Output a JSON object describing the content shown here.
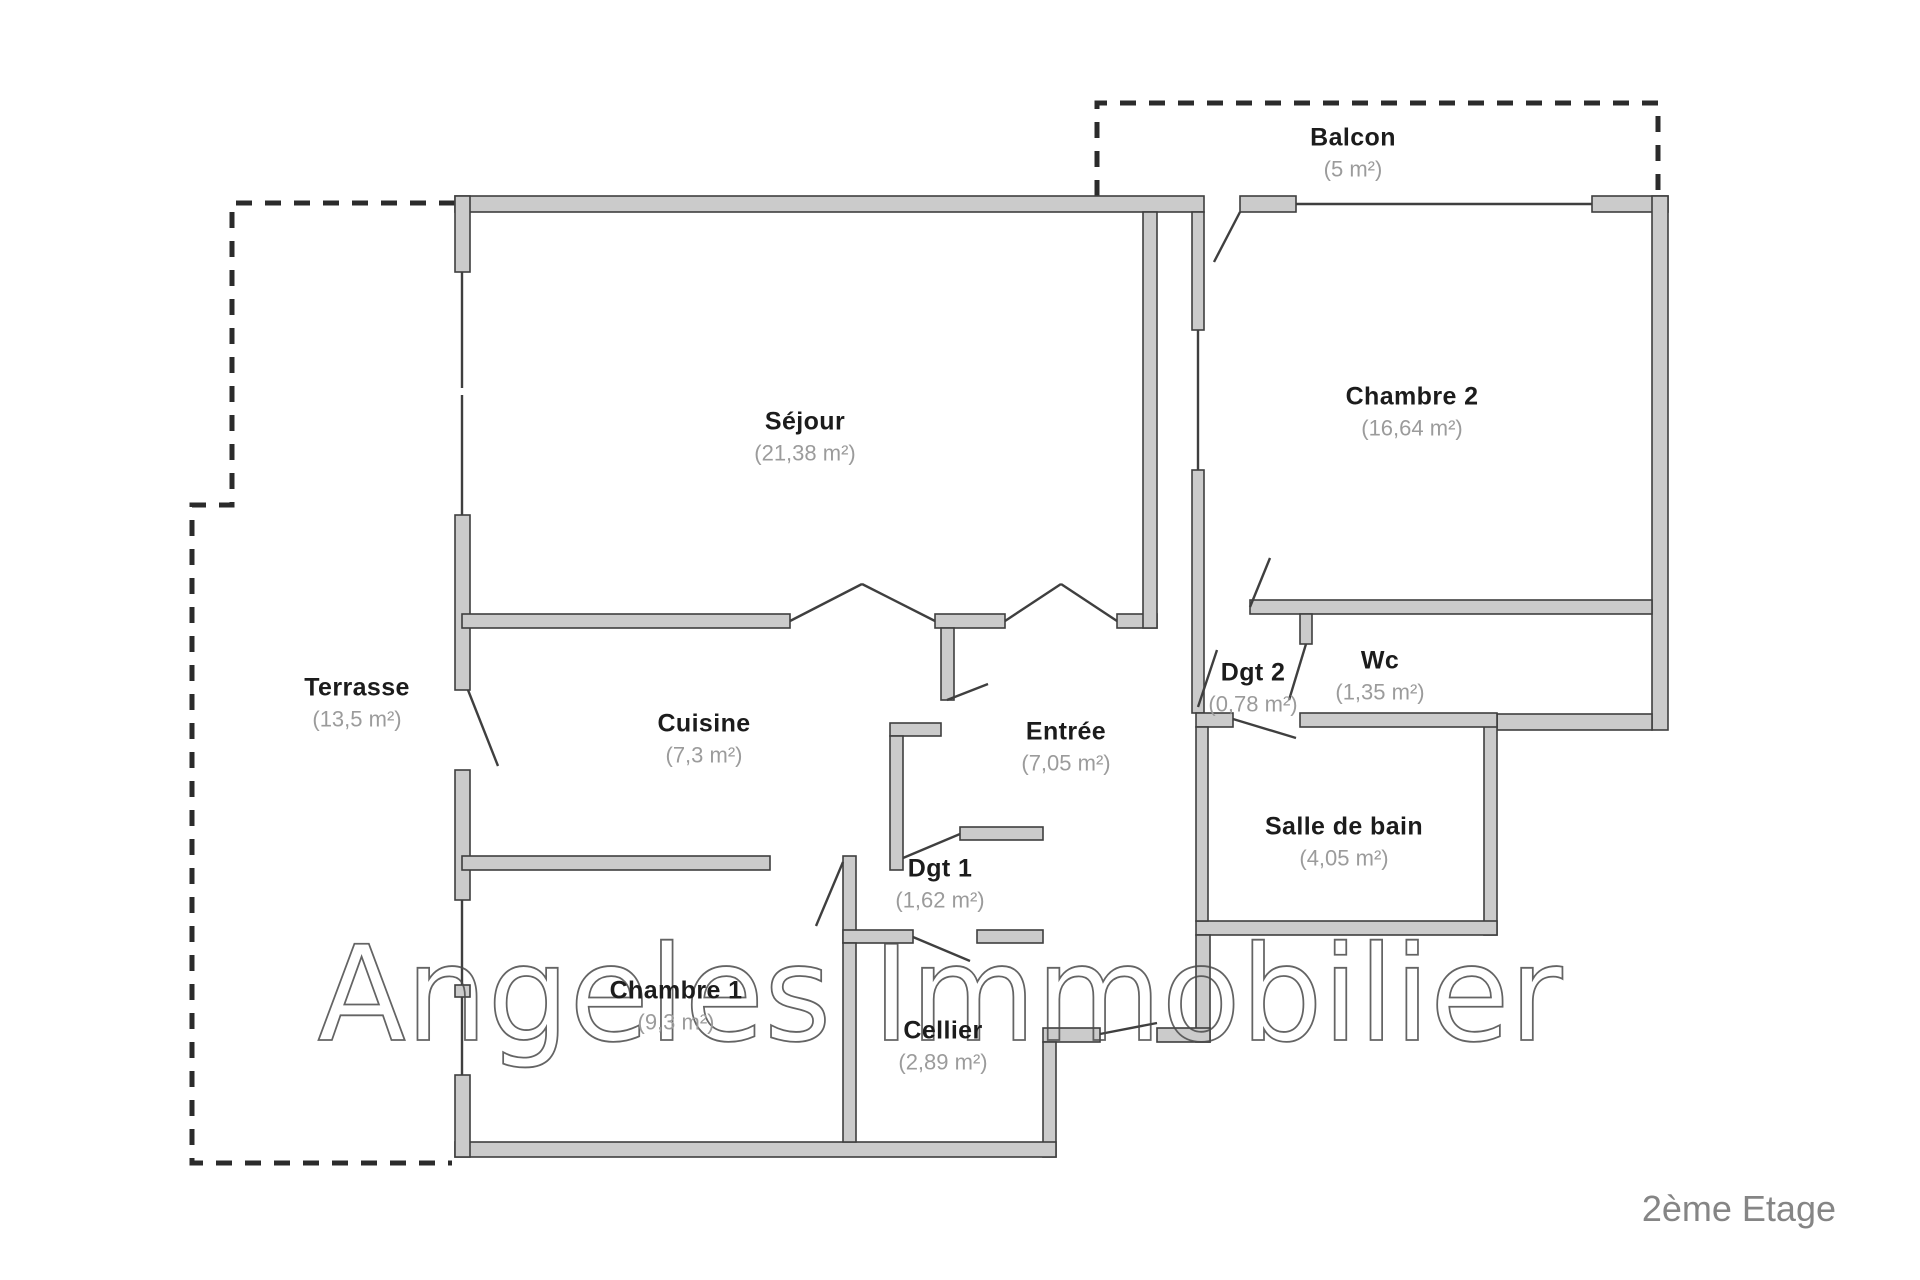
{
  "meta": {
    "watermark": "Angeles Immobilier",
    "floor_label": "2ème Etage"
  },
  "colors": {
    "wall_fill": "#cbcbcb",
    "wall_stroke": "#3f3f3f",
    "dash_color": "#2b2b2b",
    "watermark_stroke": "#4a4a4a",
    "label_color": "#1c1c1c",
    "area_color": "#9b9b9b",
    "floor_label_color": "#858585"
  },
  "rooms": [
    {
      "id": "sejour",
      "name": "Séjour",
      "area": "(21,38 m²)"
    },
    {
      "id": "chambre2",
      "name": "Chambre 2",
      "area": "(16,64 m²)"
    },
    {
      "id": "balcon",
      "name": "Balcon",
      "area": "(5 m²)"
    },
    {
      "id": "terrasse",
      "name": "Terrasse",
      "area": "(13,5 m²)"
    },
    {
      "id": "cuisine",
      "name": "Cuisine",
      "area": "(7,3 m²)"
    },
    {
      "id": "entree",
      "name": "Entrée",
      "area": "(7,05 m²)"
    },
    {
      "id": "dgt2",
      "name": "Dgt 2",
      "area": "(0,78 m²)"
    },
    {
      "id": "wc",
      "name": "Wc",
      "area": "(1,35 m²)"
    },
    {
      "id": "salle_de_bain",
      "name": "Salle de bain",
      "area": "(4,05 m²)"
    },
    {
      "id": "dgt1",
      "name": "Dgt 1",
      "area": "(1,62 m²)"
    },
    {
      "id": "chambre1",
      "name": "Chambre 1",
      "area": "(9,3 m²)"
    },
    {
      "id": "cellier",
      "name": "Cellier",
      "area": "(2,89 m²)"
    }
  ]
}
